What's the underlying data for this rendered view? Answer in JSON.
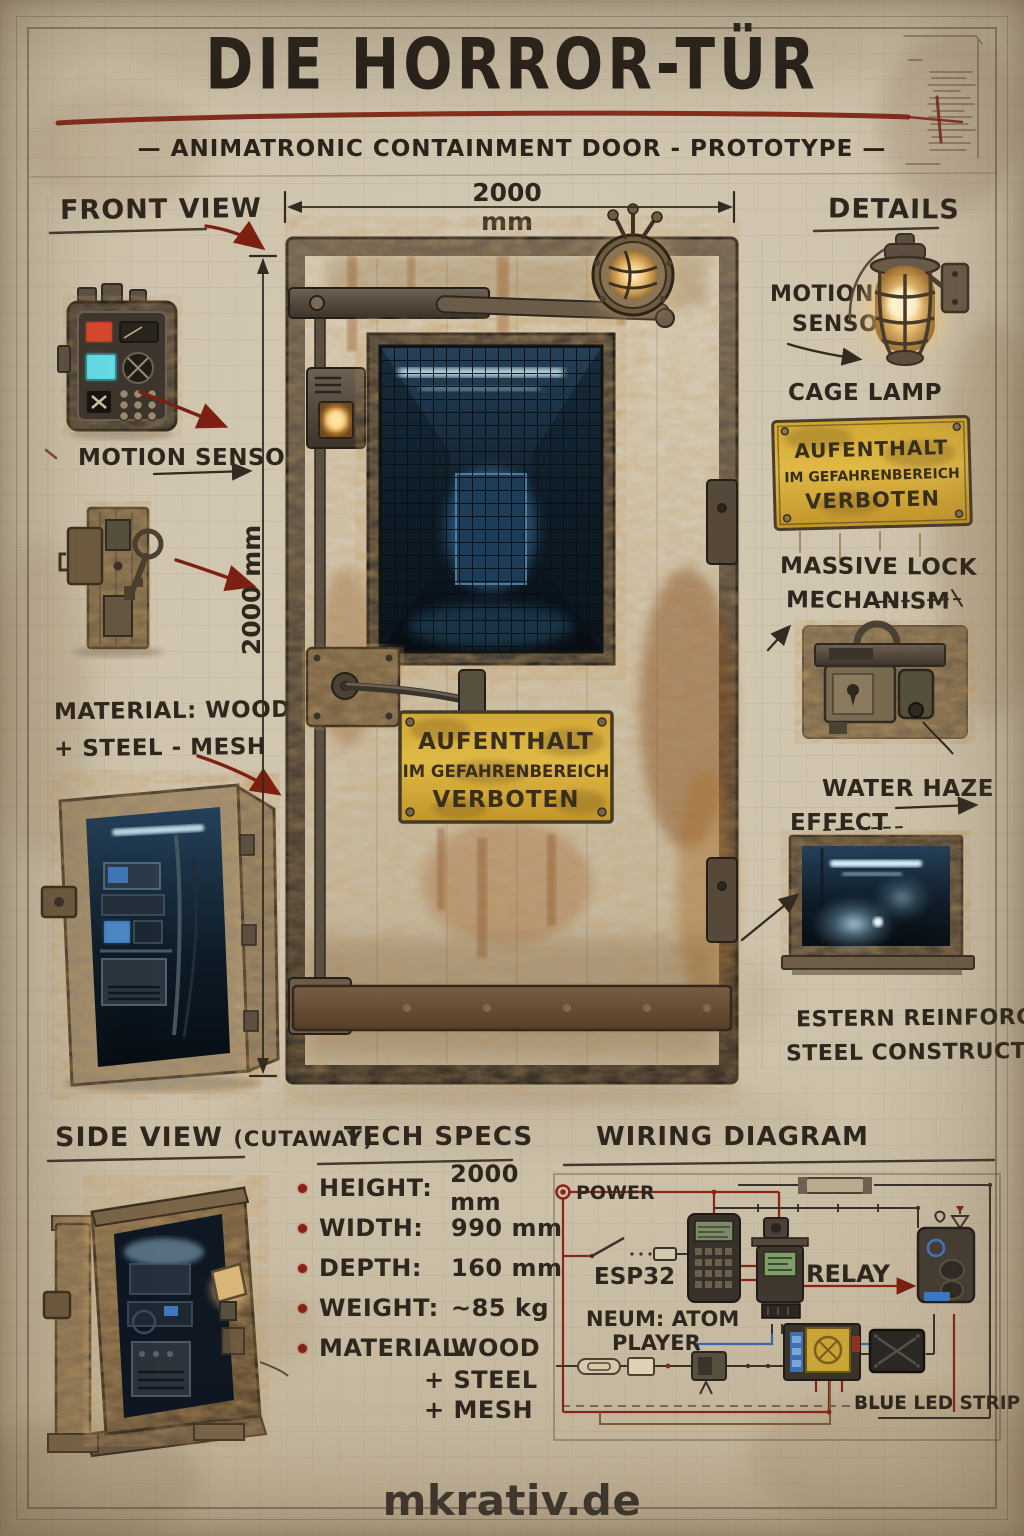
{
  "poster": {
    "title": "DIE HORROR-TÜR",
    "subtitle": "—  ANIMATRONIC CONTAINMENT DOOR - PROTOTYPE  —",
    "footer": "mkrativ.de"
  },
  "dimensions": {
    "door_width": "2000 mm",
    "door_height": "2000 mm"
  },
  "front_view": {
    "title": "FRONT VIEW",
    "motion_sensor": "MOTION SENSOR,",
    "material_line1": "MATERIAL: WOOD",
    "material_line2": "+ STEEL - MESH"
  },
  "warning_sign": {
    "line1": "AUFENTHALT",
    "line2": "IM GEFAHRENBEREICH",
    "line3": "VERBOTEN"
  },
  "details": {
    "title": "DETAILS",
    "motion_line1": "MOTION",
    "motion_line2": "SENSOR",
    "cage_lamp": "CAGE LAMP",
    "massive_lock_line1": "MASSIVE LOCK",
    "massive_lock_line2": "MECHANISM",
    "water_haze_line1": "WATER HAZE",
    "water_haze_line2": "EFFECT",
    "construction_line1": "ESTERN REINFORCED",
    "construction_line2": "STEEL CONSTRUCTION"
  },
  "side_view": {
    "title": "SIDE VIEW",
    "title_suffix": "(CUTAWAY)"
  },
  "tech_specs": {
    "title": "TECH SPECS",
    "items": [
      {
        "label": "HEIGHT:",
        "value": "2000 mm"
      },
      {
        "label": "WIDTH:",
        "value": "990 mm"
      },
      {
        "label": "DEPTH:",
        "value": "160 mm"
      },
      {
        "label": "WEIGHT:",
        "value": "~85 kg"
      },
      {
        "label": "MATERIAL:",
        "value": "WOOD"
      }
    ],
    "material_cont1": "+ STEEL",
    "material_cont2": "+ MESH"
  },
  "wiring": {
    "title": "WIRING DIAGRAM",
    "power": "POWER",
    "esp32": "ESP32",
    "relay": "RELAY",
    "player_line1": "NEUM: ATOM",
    "player_line2": "PLAYER",
    "led_strip": "BLUE LED STRIP"
  },
  "colors": {
    "paper": "#cec2ab",
    "ink": "#2e271d",
    "accent_red": "#7c2012",
    "sign_yellow": "#d8ac33",
    "rust": "#8a5526",
    "corridor_blue": "#2c5374",
    "haze_blue": "#bfe2ee"
  }
}
